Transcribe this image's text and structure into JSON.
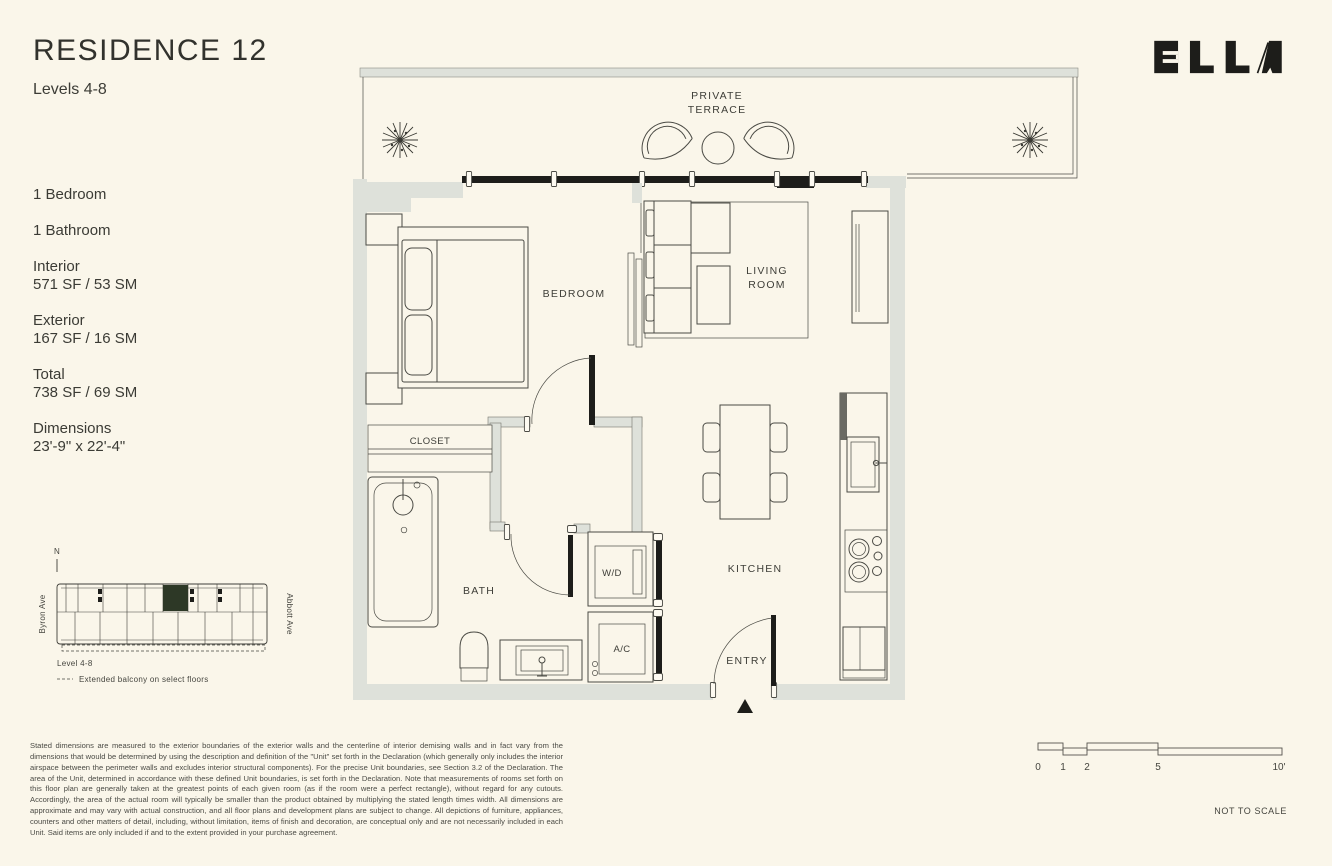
{
  "header": {
    "title": "RESIDENCE 12",
    "subtitle": "Levels 4-8",
    "brand": "ELLA"
  },
  "facts": {
    "bedroom": "1 Bedroom",
    "bathroom": "1 Bathroom",
    "interior_label": "Interior",
    "interior_value": "571 SF / 53 SM",
    "exterior_label": "Exterior",
    "exterior_value": "167 SF / 16 SM",
    "total_label": "Total",
    "total_value": "738 SF / 69 SM",
    "dimensions_label": "Dimensions",
    "dimensions_value": "23'-9\" x 22'-4\""
  },
  "plan": {
    "terrace_line1": "PRIVATE",
    "terrace_line2": "TERRACE",
    "bedroom": "BEDROOM",
    "living_line1": "LIVING",
    "living_line2": "ROOM",
    "closet": "CLOSET",
    "bath": "BATH",
    "washer_dryer": "W/D",
    "ac": "A/C",
    "kitchen": "KITCHEN",
    "entry": "ENTRY"
  },
  "keyplan": {
    "north": "N",
    "street_left": "Byron Ave",
    "street_right": "Abbott Ave",
    "level": "Level 4-8",
    "legend": "Extended balcony on select floors",
    "highlight_color": "#2d3826"
  },
  "scalebar": {
    "t0": "0",
    "t1": "1",
    "t2": "2",
    "t5": "5",
    "t10": "10'",
    "note": "NOT TO SCALE"
  },
  "disclaimer": "Stated dimensions are measured to the exterior boundaries of the exterior walls and the centerline of interior demising walls and in fact vary from the dimensions that would be determined by using the description and definition of the \"Unit\" set forth in the Declaration (which generally only includes the interior airspace between the perimeter walls and excludes interior structural components). For the precise Unit boundaries, see Section 3.2 of the Declaration. The area of the Unit, determined in accordance with these defined Unit boundaries, is set forth in the Declaration.  Note that measurements of rooms set forth on this floor plan are generally taken at the greatest points of each given room (as if the room were a perfect rectangle), without regard for any cutouts. Accordingly, the area of the actual room will typically be smaller than the product obtained by multiplying the stated length times width. All dimensions are approximate and may vary with actual construction, and all floor plans and development plans are subject to change. All depictions of furniture, appliances, counters and other matters of detail, including, without limitation, items of finish and decoration, are conceptual only and are not necessarily included in each Unit. Said items are only included if and to the extent provided in your purchase agreement.",
  "colors": {
    "background": "#faf6ea",
    "wall": "#dee1da",
    "ink": "#3c3c36",
    "black": "#1d1d1a",
    "keyplan_highlight": "#2d3826"
  }
}
